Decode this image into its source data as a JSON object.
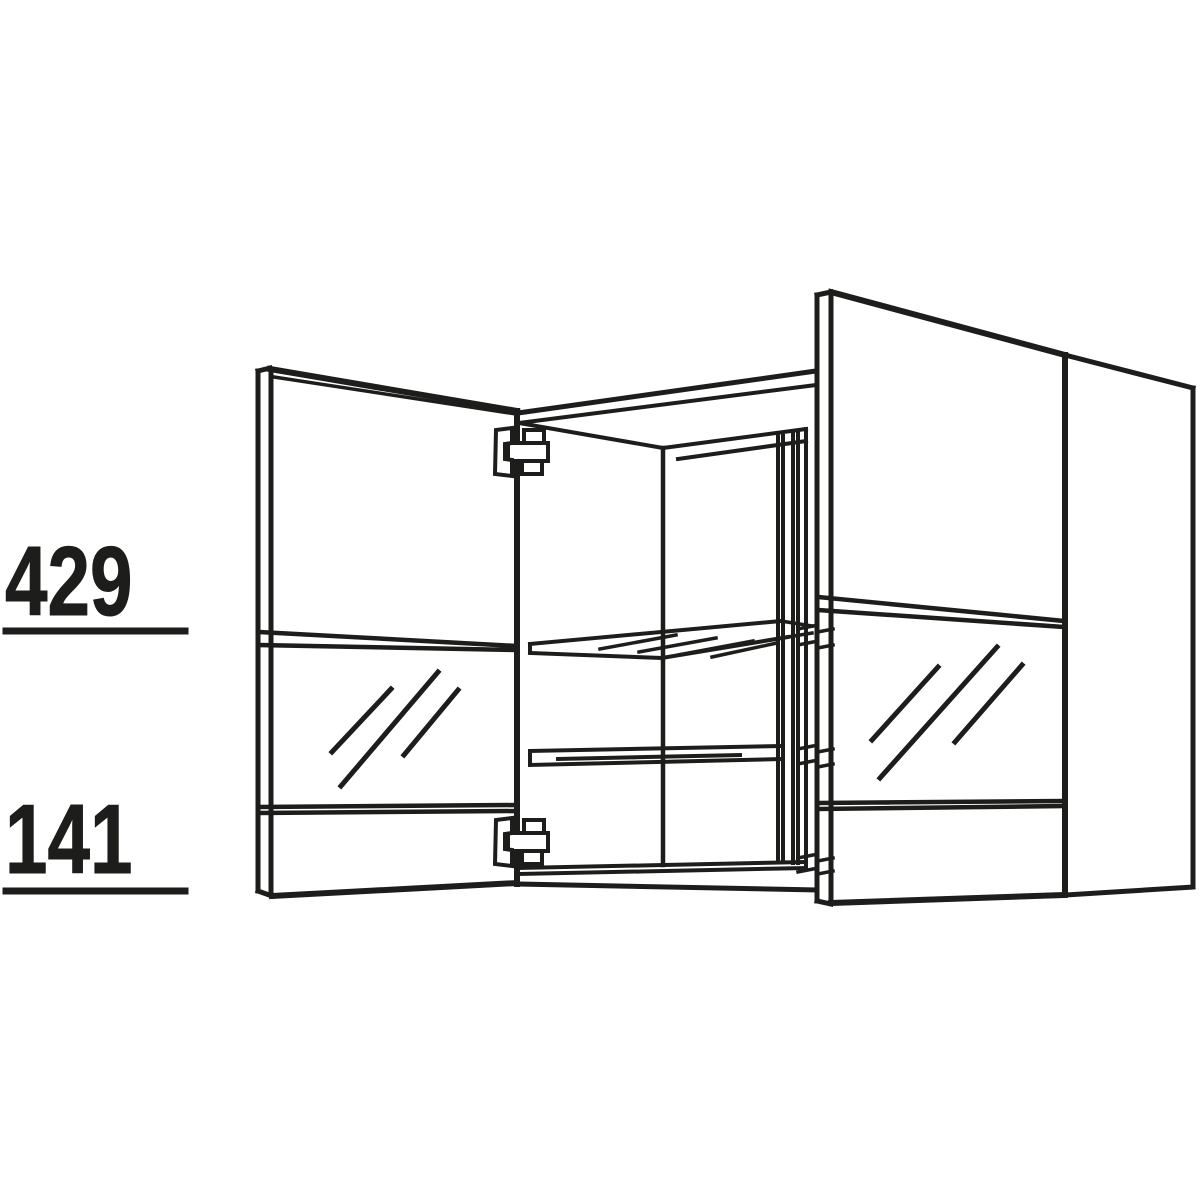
{
  "page": {
    "background_color": "#ffffff",
    "line_color": "#1d1d1b",
    "description": "Technical line drawing of a wall cabinet with two glass doors shown open, interior with two glass shelves and concealed hinges, right side panel visible"
  },
  "drawing": {
    "subject": "wall-cabinet-with-glass-doors",
    "components": [
      "left glass door (open)",
      "right glass door (open)",
      "cabinet carcass interior",
      "upper glass shelf",
      "lower glass shelf",
      "top concealed hinge",
      "bottom concealed hinge",
      "right side panel"
    ]
  },
  "dimensions": [
    {
      "name": "upper-section-height",
      "value": "429"
    },
    {
      "name": "lower-section-height",
      "value": "141"
    }
  ]
}
